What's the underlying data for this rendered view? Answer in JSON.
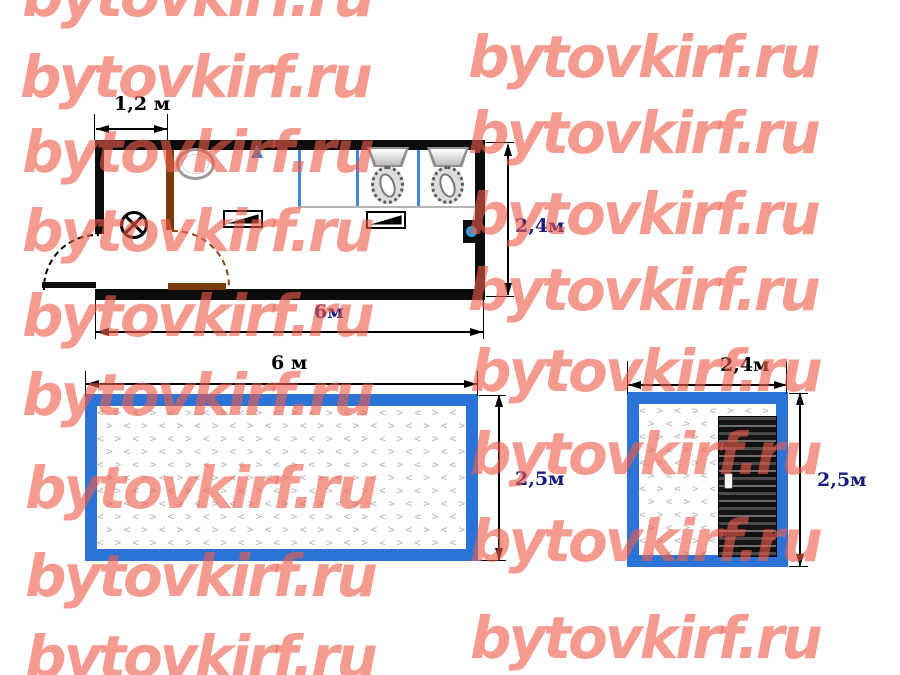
{
  "watermark": {
    "text": "bytovkirf.ru",
    "color_rgba": "rgba(238,92,74,0.62)",
    "positions": [
      [
        22,
        -38
      ],
      [
        20,
        43
      ],
      [
        22,
        118
      ],
      [
        22,
        197
      ],
      [
        22,
        282
      ],
      [
        22,
        361
      ],
      [
        25,
        454
      ],
      [
        25,
        542
      ],
      [
        25,
        623
      ],
      [
        468,
        23
      ],
      [
        468,
        99
      ],
      [
        468,
        180
      ],
      [
        468,
        256
      ],
      [
        470,
        337
      ],
      [
        470,
        420
      ],
      [
        470,
        507
      ],
      [
        470,
        604
      ]
    ]
  },
  "floor_plan": {
    "dim_entry_width": "1,2 м",
    "dim_length": "6м",
    "dim_depth": "2,4м"
  },
  "front_elevation": {
    "dim_length": "6 м",
    "dim_height": "2,5м"
  },
  "side_elevation": {
    "dim_width": "2,4м",
    "dim_height": "2,5м"
  },
  "icons": {
    "lamp": "ceiling-lamp (circle with X)",
    "sink": "wash-basin oval",
    "water_drop": "blue water drop",
    "toilet": "toilet with cistern (x2)",
    "bench": "bench/table symbol (x2)",
    "water_heater": "blue dot on right wall",
    "door_swing": "quarter-circle door swing arcs"
  },
  "colors": {
    "frame_blue": "#2b73d6",
    "stall_partition_blue": "#3f86dd",
    "interior_partition_brown": "#7a3a0c",
    "dim_label_navy": "#1b1b7e",
    "watermark_red": "rgba(238,92,74,0.62)",
    "pattern_gray": "#b4b4b4"
  }
}
